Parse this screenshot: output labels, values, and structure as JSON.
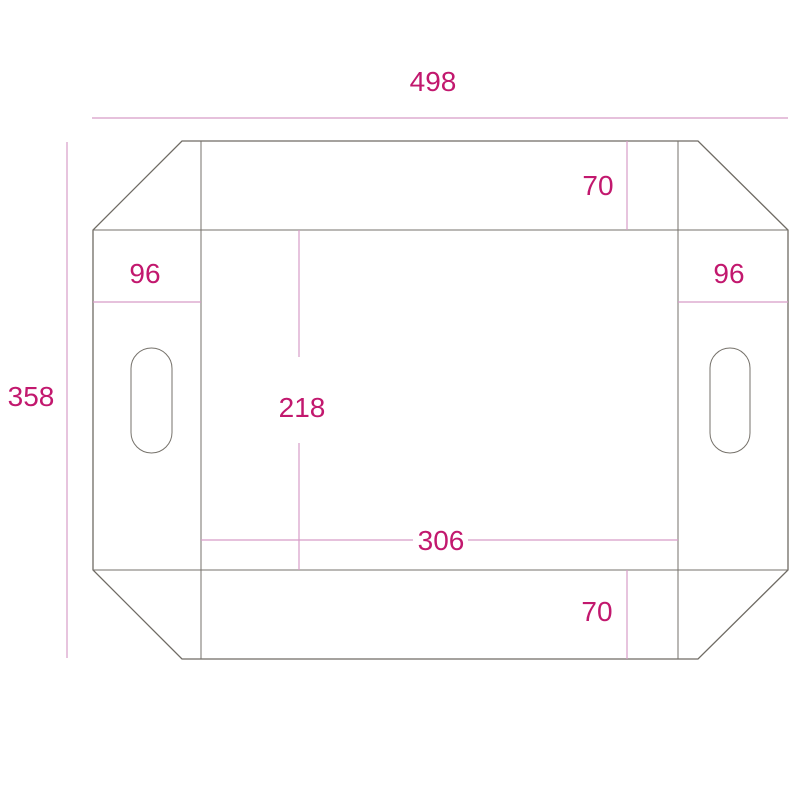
{
  "diagram": {
    "description": "tray-box dieline technical drawing with chamfered corners and handle cutouts",
    "colors": {
      "background": "#ffffff",
      "outline": "#6f6b64",
      "dimension_line": "#d79cc8",
      "dimension_text": "#c2186e"
    },
    "labels": {
      "overall_width": "498",
      "overall_height": "358",
      "top_flap_depth": "70",
      "bottom_flap_depth": "70",
      "left_side_width": "96",
      "right_side_width": "96",
      "base_height": "218",
      "base_width": "306"
    }
  }
}
